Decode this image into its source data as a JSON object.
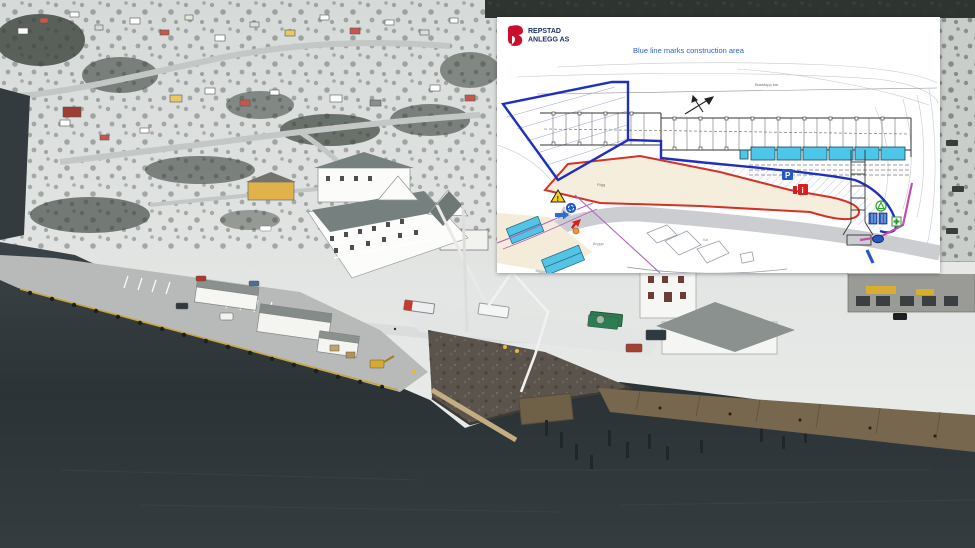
{
  "plan": {
    "logo": {
      "line1": "REPSTAD",
      "line2": "ANLEGG AS"
    },
    "note": "Blue line marks construction area",
    "signs": {
      "parking": "P",
      "info": "i",
      "warning": "!"
    },
    "labels": {
      "road": "Busstopp kai",
      "rig_area": "Rigg",
      "quay": "Brygge",
      "pier": "Kai"
    },
    "colors": {
      "boundary_blue": "#1f2fbf",
      "area_red": "#d23326",
      "building_cyan": "#4cc7e9",
      "note_blue": "#2a61cc",
      "logo_red": "#c8102e",
      "logo_navy": "#1b2f6b",
      "magenta": "#c04fb0",
      "warning_yellow": "#f7d21a",
      "parking_sign_blue": "#2458c4",
      "first_aid_green": "#269a26"
    }
  }
}
